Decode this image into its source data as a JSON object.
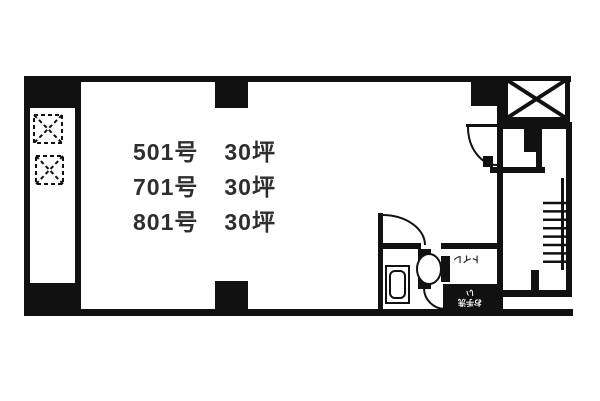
{
  "plan": {
    "units": [
      {
        "room": "501号",
        "area": "30坪"
      },
      {
        "room": "701号",
        "area": "30坪"
      },
      {
        "room": "801号",
        "area": "30坪"
      }
    ],
    "labels": {
      "toilet": "トイレ",
      "washroom": "お手洗い"
    },
    "colors": {
      "wall": "#111111",
      "text": "#2e2e2e",
      "background": "#ffffff"
    }
  }
}
